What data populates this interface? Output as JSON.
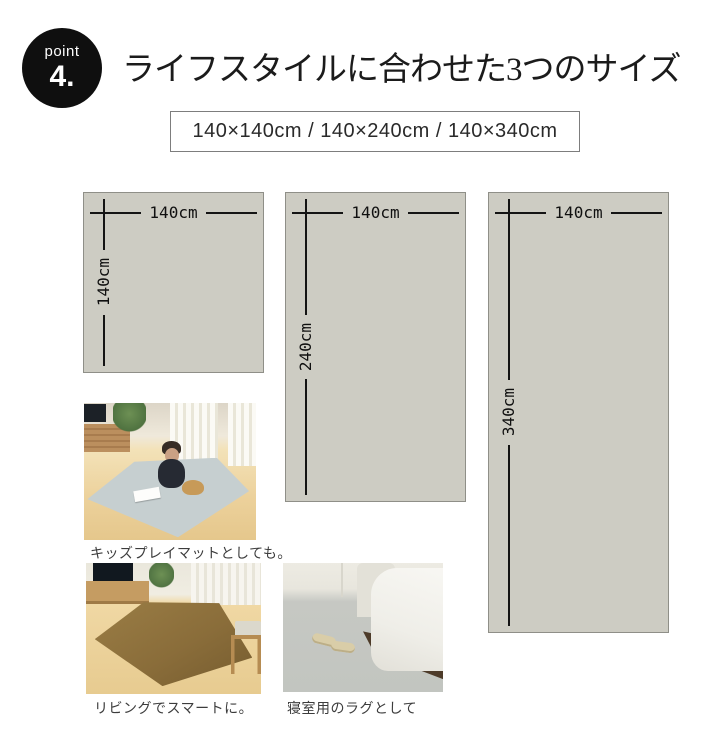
{
  "badge": {
    "label": "point",
    "number": "4."
  },
  "title": "ライフスタイルに合わせた3つのサイズ",
  "size_list": "140×140cm / 140×240cm / 140×340cm",
  "size_diagrams": [
    {
      "name": "140x140",
      "width_label": "140cm",
      "height_label": "140cm"
    },
    {
      "name": "140x240",
      "width_label": "140cm",
      "height_label": "240cm"
    },
    {
      "name": "140x340",
      "width_label": "140cm",
      "height_label": "340cm"
    }
  ],
  "photo_captions": [
    "キッズプレイマットとしても。",
    "リビングでスマートに。",
    "寝室用のラグとして"
  ],
  "colors": {
    "badge_bg": "#0f0f0f",
    "badge_text": "#ffffff",
    "title_text": "#1b1b1b",
    "size_box_border": "#7d7d7d",
    "rect_fill": "#cdccc3",
    "rect_border": "#8f8f88",
    "dim_line": "#141414",
    "rug_blue": "#c6cfd0",
    "rug_brown": "#8a6d3a",
    "carpet_gray": "#c6c8c3"
  }
}
